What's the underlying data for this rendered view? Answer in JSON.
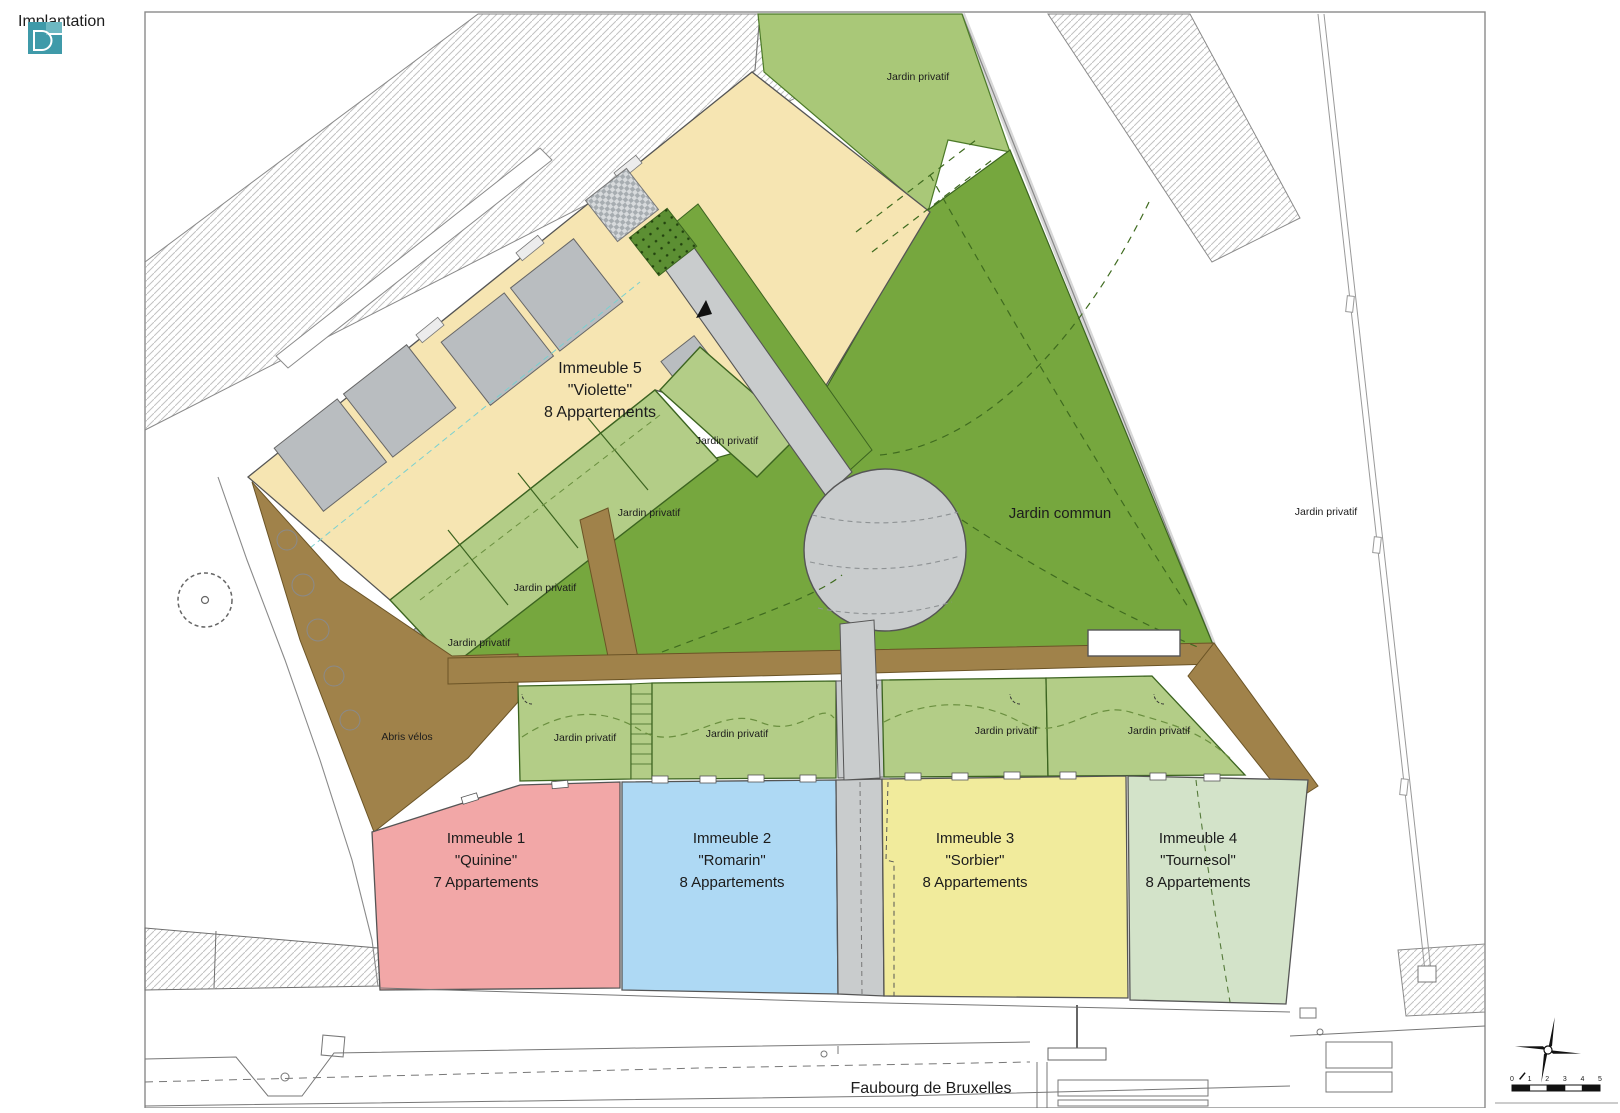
{
  "title": "Implantation",
  "labels": {
    "jardin_commun": "Jardin commun",
    "jardin_privatif": "Jardin privatif",
    "abris_velos": "Abris vélos",
    "street": "Faubourg de Bruxelles"
  },
  "buildings": {
    "b1": {
      "title": "Immeuble 1",
      "name": "\"Quinine\"",
      "units": "7 Appartements"
    },
    "b2": {
      "title": "Immeuble 2",
      "name": "\"Romarin\"",
      "units": "8 Appartements"
    },
    "b3": {
      "title": "Immeuble 3",
      "name": "\"Sorbier\"",
      "units": "8 Appartements"
    },
    "b4": {
      "title": "Immeuble 4",
      "name": "\"Tournesol\"",
      "units": "8 Appartements"
    },
    "b5": {
      "title": "Immeuble 5",
      "name": "\"Violette\"",
      "units": "8 Appartements"
    }
  },
  "scale": {
    "ticks": [
      "0",
      "1",
      "2",
      "3",
      "4",
      "5"
    ]
  },
  "colors": {
    "building5_fill": "#f6e5b2",
    "building1_fill": "#f2a7a7",
    "building2_fill": "#aed9f4",
    "building3_fill": "#f1eb9c",
    "building4_fill": "#d3e3c9",
    "jardin_privatif_fill": "#b3cd87",
    "jardin_commun_fill": "#76a73e",
    "path_brown_fill": "#a0824a",
    "walkway_gray_fill": "#c9cccd",
    "logo_teal": "#3f9aa9"
  }
}
